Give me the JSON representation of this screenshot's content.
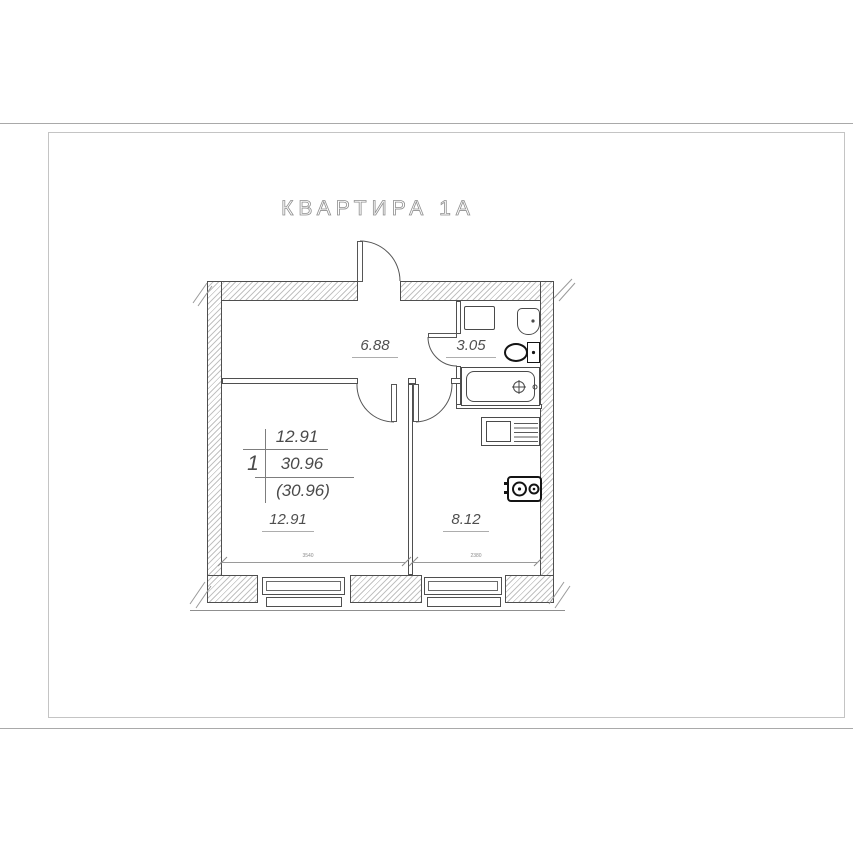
{
  "title": "КВАРТИРА 1А",
  "stamp": {
    "rooms_count": "1",
    "living_area": "12.91",
    "total_area": "30.96",
    "total_area_with_summer": "(30.96)"
  },
  "rooms": {
    "hall": {
      "area": "6.88"
    },
    "bathroom": {
      "area": "3.05"
    },
    "living": {
      "area": "12.91"
    },
    "kitchen": {
      "area": "8.12"
    }
  },
  "dims": {
    "living_width": "3540",
    "kitchen_width": "2380"
  },
  "colors": {
    "line": "#4f4f4f",
    "hatch": "#c2c2c2",
    "text": "#4a4a4a",
    "frame_border": "#c4c4c4",
    "bold_fixture": "#141414"
  }
}
